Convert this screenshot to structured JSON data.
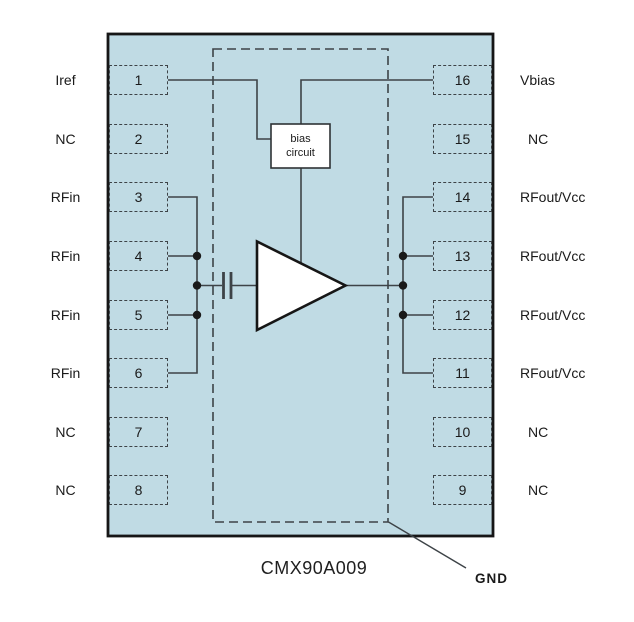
{
  "title": "CMX90A009",
  "gnd_callout": "GND",
  "bias_circuit": {
    "line1": "bias",
    "line2": "circuit"
  },
  "colors": {
    "chip_fill": "#c0dbe4",
    "chip_outline": "#161616",
    "wire": "#3d4347",
    "background": "#ffffff"
  },
  "pins": {
    "left": [
      {
        "number": "1",
        "label": "Iref"
      },
      {
        "number": "2",
        "label": "NC"
      },
      {
        "number": "3",
        "label": "RFin"
      },
      {
        "number": "4",
        "label": "RFin"
      },
      {
        "number": "5",
        "label": "RFin"
      },
      {
        "number": "6",
        "label": "RFin"
      },
      {
        "number": "7",
        "label": "NC"
      },
      {
        "number": "8",
        "label": "NC"
      }
    ],
    "right": [
      {
        "number": "16",
        "label": "Vbias"
      },
      {
        "number": "15",
        "label": "NC"
      },
      {
        "number": "14",
        "label": "RFout/Vcc"
      },
      {
        "number": "13",
        "label": "RFout/Vcc"
      },
      {
        "number": "12",
        "label": "RFout/Vcc"
      },
      {
        "number": "11",
        "label": "RFout/Vcc"
      },
      {
        "number": "10",
        "label": "NC"
      },
      {
        "number": "9",
        "label": "NC"
      }
    ]
  }
}
